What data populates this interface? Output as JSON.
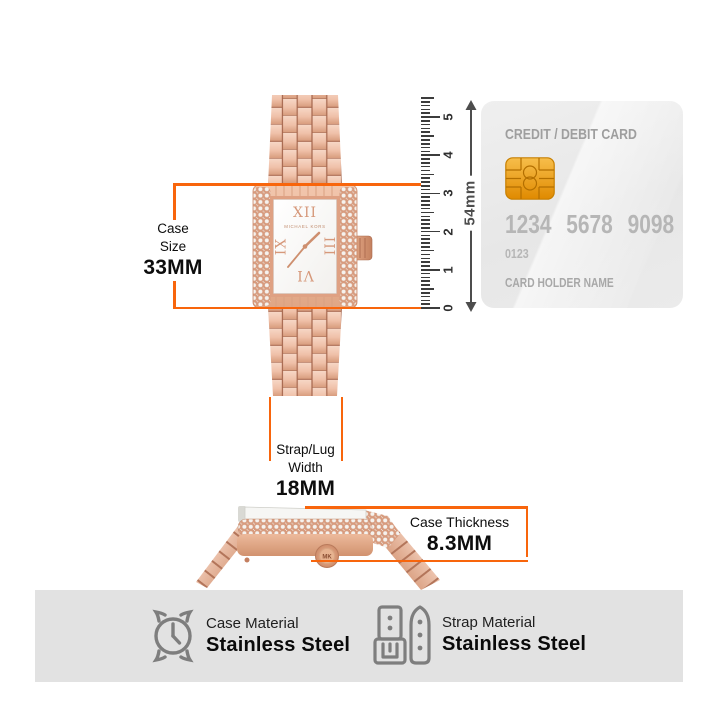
{
  "annotations": {
    "case_size": {
      "line1": "Case",
      "line2": "Size",
      "value": "33MM"
    },
    "strap_width": {
      "line1": "Strap/Lug",
      "line2": "Width",
      "value": "18MM"
    },
    "case_thickness": {
      "label": "Case Thickness",
      "value": "8.3MM"
    }
  },
  "ruler": {
    "labels": [
      "0",
      "1",
      "2",
      "3",
      "4",
      "5"
    ]
  },
  "card": {
    "title": "CREDIT / DEBIT CARD",
    "number_groups": [
      "1234",
      "5678",
      "9098"
    ],
    "sub_number": "0123",
    "holder_label": "CARD HOLDER NAME",
    "height_label": "54mm"
  },
  "watch": {
    "brand": "MICHAEL KORS",
    "numeral_12": "XII",
    "numeral_3": "III",
    "numeral_6": "VI",
    "numeral_9": "IX",
    "crown_text": "MK"
  },
  "materials": [
    {
      "icon": "watch-case-icon",
      "label": "Case Material",
      "value": "Stainless Steel"
    },
    {
      "icon": "watch-strap-icon",
      "label": "Strap Material",
      "value": "Stainless Steel"
    }
  ],
  "colors": {
    "orange": "#F8650C",
    "rose_mid": "#E8B295",
    "chip_gold": "#F2A93B",
    "bar_bg": "#E2E2E2",
    "card_bg": "#EAEAEA"
  }
}
